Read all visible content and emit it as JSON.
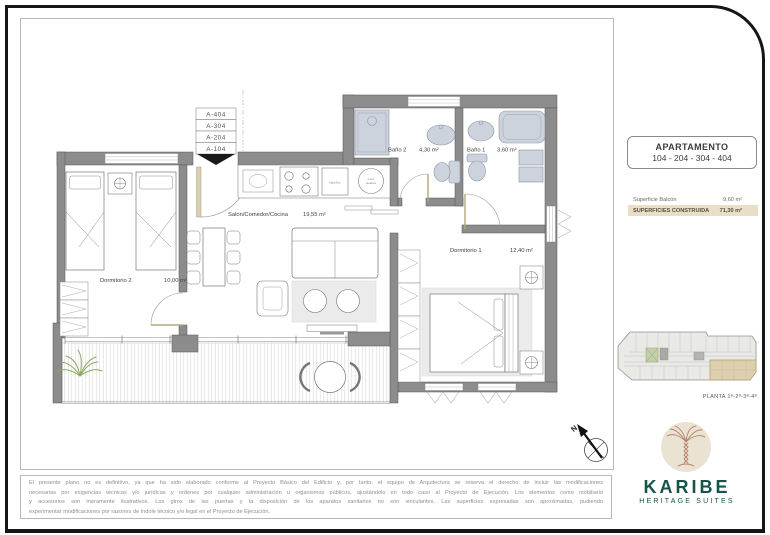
{
  "unit_stack": {
    "items": [
      "A-404",
      "A-304",
      "A-204",
      "A-104"
    ]
  },
  "plan": {
    "rooms": {
      "bano2": {
        "name": "Baño 2",
        "area": "4,30 m²"
      },
      "bano1": {
        "name": "Baño 1",
        "area": "3,60 m²"
      },
      "salon": {
        "name": "Salón/Comedor/Cocina",
        "area": "19,55 m²"
      },
      "dorm2": {
        "name": "Dormitorio 2",
        "area": "10,00 m²"
      },
      "dorm1": {
        "name": "Dormitorio 1",
        "area": "12,40 m²"
      }
    },
    "appliances": {
      "fridge": "frigorífico",
      "washer_1": "termo",
      "washer_2": "lavadora"
    },
    "north": "N"
  },
  "info_panel": {
    "apartment_title": "APARTAMENTO",
    "apartment_numbers": "104 - 204 - 304 - 404",
    "surface_rows": [
      {
        "label": "Superficie Balcón",
        "value": "9,60 m²"
      },
      {
        "label": "SUPERFICIES CONSTRUIDA",
        "value": "71,30 m²"
      }
    ],
    "key_plan_label": "PLANTA 1ª-2ª-3ª-4ª"
  },
  "brand": {
    "name": "KARIBE",
    "tagline": "HERITAGE SUITES"
  },
  "colors": {
    "brand_green": "#14544a",
    "palm_line": "#b5806a",
    "logo_circle": "#eae3d3",
    "highlight_beige": "#eadfc6",
    "wall_gray": "#8c8c8c"
  },
  "disclaimer": {
    "lines": [
      "El presente plano no es definitivo, ya que ha sido elaborado conforme al Proyecto Básico del Edificio y, por tanto, el equipo de Arquitectura se reserva el derecho de incluir las modificaciones",
      "necesarias por exigencias técnicas y/o jurídicas y ordenes por cualquier administración u organismos públicos, ajustándolo en todo caso al Proyecto de Ejecución. Los elementos como mobiliario",
      "y accesorios son meramente ilustrativos. Los giros de las puertas y la disposición de los aparatos sanitarios no son vinculantes. Las superficies expresadas son aproximadas, pudiendo",
      "experimentar modificaciones por razones de índole técnico y/o legal en el Proyecto de Ejecución."
    ]
  }
}
